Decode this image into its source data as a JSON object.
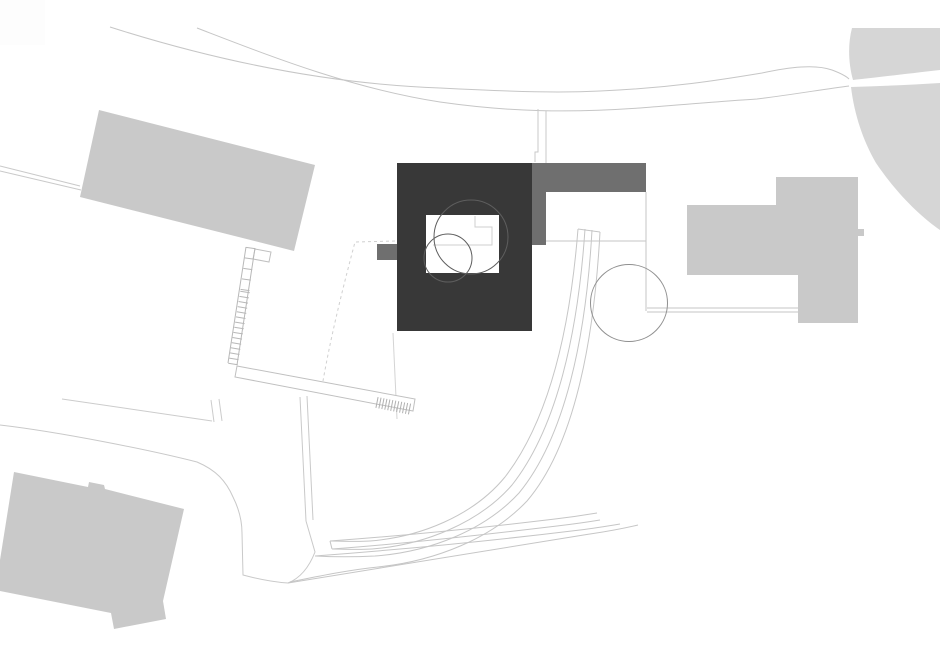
{
  "canvas": {
    "w": 940,
    "h": 646,
    "bg": "#ffffff"
  },
  "palette": {
    "building_light": "#c9c9c9",
    "building_mid": "#6f6f6f",
    "building_dark": "#383838",
    "terrain": "#d6d6d6",
    "line_light": "#c6c6c6",
    "line_mid": "#a8a8a8",
    "tree_line": "#8f8f8f",
    "court_tree_line": "#5e5e5e",
    "corner_patch": "#fdfdfd"
  },
  "shapes": [
    {
      "name": "corner-patch",
      "type": "rect",
      "x": 0,
      "y": 0,
      "w": 45,
      "h": 45,
      "fill": "#fdfdfd"
    },
    {
      "name": "terrain-upper-right",
      "type": "path",
      "fill": "#d6d6d6",
      "d": "M852,28 L940,28 L940,70 C905,74 872,78 853,80 C848,62 848,43 852,28 Z"
    },
    {
      "name": "terrain-lower-right",
      "type": "path",
      "fill": "#d6d6d6",
      "d": "M851,87 C880,86 910,85 940,83 L940,230 C921,217 897,194 876,163 C862,139 854,112 851,87 Z"
    },
    {
      "name": "road-upper-edge",
      "type": "path",
      "stroke": "#c6c6c6",
      "d": "M110,27 C220,62 330,84 440,88 C520,92 560,93 600,91 C670,88 720,80 762,73 C790,67 815,64 832,70 C840,73 846,76 849,79"
    },
    {
      "name": "road-lower-edge",
      "type": "path",
      "stroke": "#c6c6c6",
      "d": "M197,28 C270,56 350,88 440,102 C510,112 570,113 640,108 C690,104 725,101 757,99 C790,95 825,89 849,86"
    },
    {
      "name": "entry-walk-lines",
      "type": "path",
      "stroke": "#c9c9c9",
      "d": "M538,109 L538,152 L535,152 L535,162 M546,111 L546,163"
    },
    {
      "name": "left-boundary-path",
      "type": "path",
      "stroke": "#c9c9c9",
      "d": "M0,166 L80,186 M0,171 L81,190"
    },
    {
      "name": "road-boundary-west",
      "type": "path",
      "stroke": "#c9c9c9",
      "d": "M0,425 C60,432 150,450 197,462 C216,470 226,481 233,497 C239,509 242,520 242,533 L243,575 C258,579 272,582 288,583"
    },
    {
      "name": "road-bulge-outline",
      "type": "path",
      "stroke": "#c9c9c9",
      "d": "M306,521 L315,552 C308,570 298,579 288,583"
    },
    {
      "name": "mid-footpath-lines",
      "type": "path",
      "stroke": "#c9c9c9",
      "d": "M300,397 L306,521 M307,396 L313,520"
    },
    {
      "name": "lower-side-path",
      "type": "path",
      "stroke": "#cccccc",
      "d": "M62,399 L212,421 M211,400 L214,422 M219,399 L222,421"
    },
    {
      "name": "parcel-dashed-line",
      "type": "path",
      "stroke": "#d0d0d0",
      "dash": "3 3",
      "d": "M395,241 L355,242 C345,280 332,330 323,381"
    },
    {
      "name": "axis-faint-line",
      "type": "path",
      "stroke": "#d4d4d4",
      "d": "M393,333 L397,419"
    },
    {
      "name": "ramp-cap",
      "type": "path",
      "stroke": "#c6c6c6",
      "d": "M578,229 L600,232"
    },
    {
      "name": "ramp-curve-1",
      "type": "path",
      "stroke": "#c6c6c6",
      "d": "M578,229 C570,330 549,420 505,477 C473,516 420,537 370,541 C356,542 341,541 330,541"
    },
    {
      "name": "ramp-curve-2",
      "type": "path",
      "stroke": "#c6c6c6",
      "d": "M585,229 C578,333 557,428 512,485 C479,523 424,545 372,549 C357,550 343,549 332,549"
    },
    {
      "name": "ramp-curve-3",
      "type": "path",
      "stroke": "#c6c6c6",
      "d": "M592,230 C586,338 565,437 519,493 C485,530 430,552 375,556 C355,557 333,557 315,556"
    },
    {
      "name": "ramp-curve-4",
      "type": "path",
      "stroke": "#c6c6c6",
      "d": "M600,232 C594,342 574,446 527,501 C492,538 436,561 378,567 C348,570 315,577 290,582"
    },
    {
      "name": "wall-band-upper",
      "type": "path",
      "stroke": "#c6c6c6",
      "d": "M330,541 C400,536 480,528 555,519 C572,517 585,515 597,513"
    },
    {
      "name": "wall-band-lower",
      "type": "path",
      "stroke": "#c6c6c6",
      "d": "M332,549 C402,544 482,535 557,526 C574,524 588,522 600,520"
    },
    {
      "name": "wall-band-cap",
      "type": "path",
      "stroke": "#c6c6c6",
      "d": "M330,541 L332,549"
    },
    {
      "name": "outer-arc-1",
      "type": "path",
      "stroke": "#c6c6c6",
      "d": "M315,556 C395,550 490,541 580,530 C596,528 608,526 620,524"
    },
    {
      "name": "outer-arc-2",
      "type": "path",
      "stroke": "#c6c6c6",
      "d": "M288,583 C370,569 480,551 590,534 C610,531 625,528 638,525"
    },
    {
      "name": "terrace-edge-bottom",
      "type": "path",
      "stroke": "#c6c6c6",
      "d": "M546,241 L646,241"
    },
    {
      "name": "terrace-edge-right",
      "type": "path",
      "stroke": "#c6c6c6",
      "d": "M646,192 L646,311"
    },
    {
      "name": "path-to-east-building",
      "type": "path",
      "stroke": "#c6c6c6",
      "d": "M647,308 L798,308 M647,312 L798,312"
    },
    {
      "name": "tree-circle-east",
      "type": "circle",
      "cx": 629,
      "cy": 303,
      "r": 38.5,
      "stroke": "#8f8f8f"
    },
    {
      "name": "building-northwest",
      "type": "polygon",
      "fill": "#c9c9c9",
      "points": "99,110 315,165 294,251 80,197"
    },
    {
      "name": "stair-landing",
      "type": "polygon",
      "stroke": "#c0c0c0",
      "fill": "#ffffff",
      "points": "255,249 271,252 269,262 253,259"
    },
    {
      "name": "stair-rails",
      "type": "path",
      "stroke": "#b8b8b8",
      "d": "M246,247 L228,363 M255,248 L237,365"
    },
    {
      "name": "stair-treads-upper",
      "type": "rungs",
      "x1": 250.5,
      "y1": 248,
      "x2": 245,
      "y2": 290,
      "hw": 4.5,
      "n": 5,
      "stroke": "#b8b8b8"
    },
    {
      "name": "stair-treads-lower",
      "type": "rungs",
      "x1": 245,
      "y1": 292,
      "x2": 233,
      "y2": 364,
      "hw": 4.8,
      "n": 15,
      "stroke": "#b8b8b8"
    },
    {
      "name": "walkway-band",
      "type": "polygon",
      "stroke": "#c0c0c0",
      "fill": "#ffffff",
      "points": "237,366 415,399 413,411 235,377"
    },
    {
      "name": "walkway-stair-hatch",
      "type": "rungs",
      "x1": 377,
      "y1": 402.5,
      "x2": 409.5,
      "y2": 409,
      "hw": 5.5,
      "n": 12,
      "stroke": "#b0b0b0"
    },
    {
      "name": "building-southwest",
      "type": "polygon",
      "fill": "#c9c9c9",
      "points": "14,472 88,487 89,482 104,485 105,489 184,509 163,601 166,619 114,629 111,613 0,591 0,560"
    },
    {
      "name": "building-east",
      "type": "polygon",
      "fill": "#c9c9c9",
      "points": "687,205 776,205 776,177 858,177 858,323 798,323 798,275 687,275"
    },
    {
      "name": "building-east-stub",
      "type": "rect",
      "x": 858,
      "y": 229,
      "w": 6,
      "h": 7,
      "fill": "#c9c9c9"
    },
    {
      "name": "main-house-body",
      "type": "rect",
      "x": 397,
      "y": 163,
      "w": 135,
      "h": 168,
      "fill": "#383838"
    },
    {
      "name": "main-house-wing",
      "type": "rect",
      "x": 532,
      "y": 163,
      "w": 114,
      "h": 29,
      "fill": "#6f6f6f"
    },
    {
      "name": "main-house-wing-leg",
      "type": "rect",
      "x": 532,
      "y": 192,
      "w": 14,
      "h": 53,
      "fill": "#6f6f6f"
    },
    {
      "name": "main-house-west-stub",
      "type": "rect",
      "x": 377,
      "y": 244,
      "w": 20,
      "h": 16,
      "fill": "#6f6f6f"
    },
    {
      "name": "courtyard",
      "type": "rect",
      "x": 426,
      "y": 215,
      "w": 73,
      "h": 58,
      "fill": "#ffffff"
    },
    {
      "name": "courtyard-step-line",
      "type": "path",
      "stroke": "#cfcfcf",
      "d": "M475,216 L475,227 L492,227 L492,245 L433,245"
    },
    {
      "name": "courtyard-tree-large",
      "type": "circle",
      "cx": 471,
      "cy": 237,
      "r": 37,
      "stroke": "#5e5e5e"
    },
    {
      "name": "courtyard-tree-small",
      "type": "circle",
      "cx": 448,
      "cy": 258,
      "r": 24,
      "stroke": "#5e5e5e"
    }
  ]
}
